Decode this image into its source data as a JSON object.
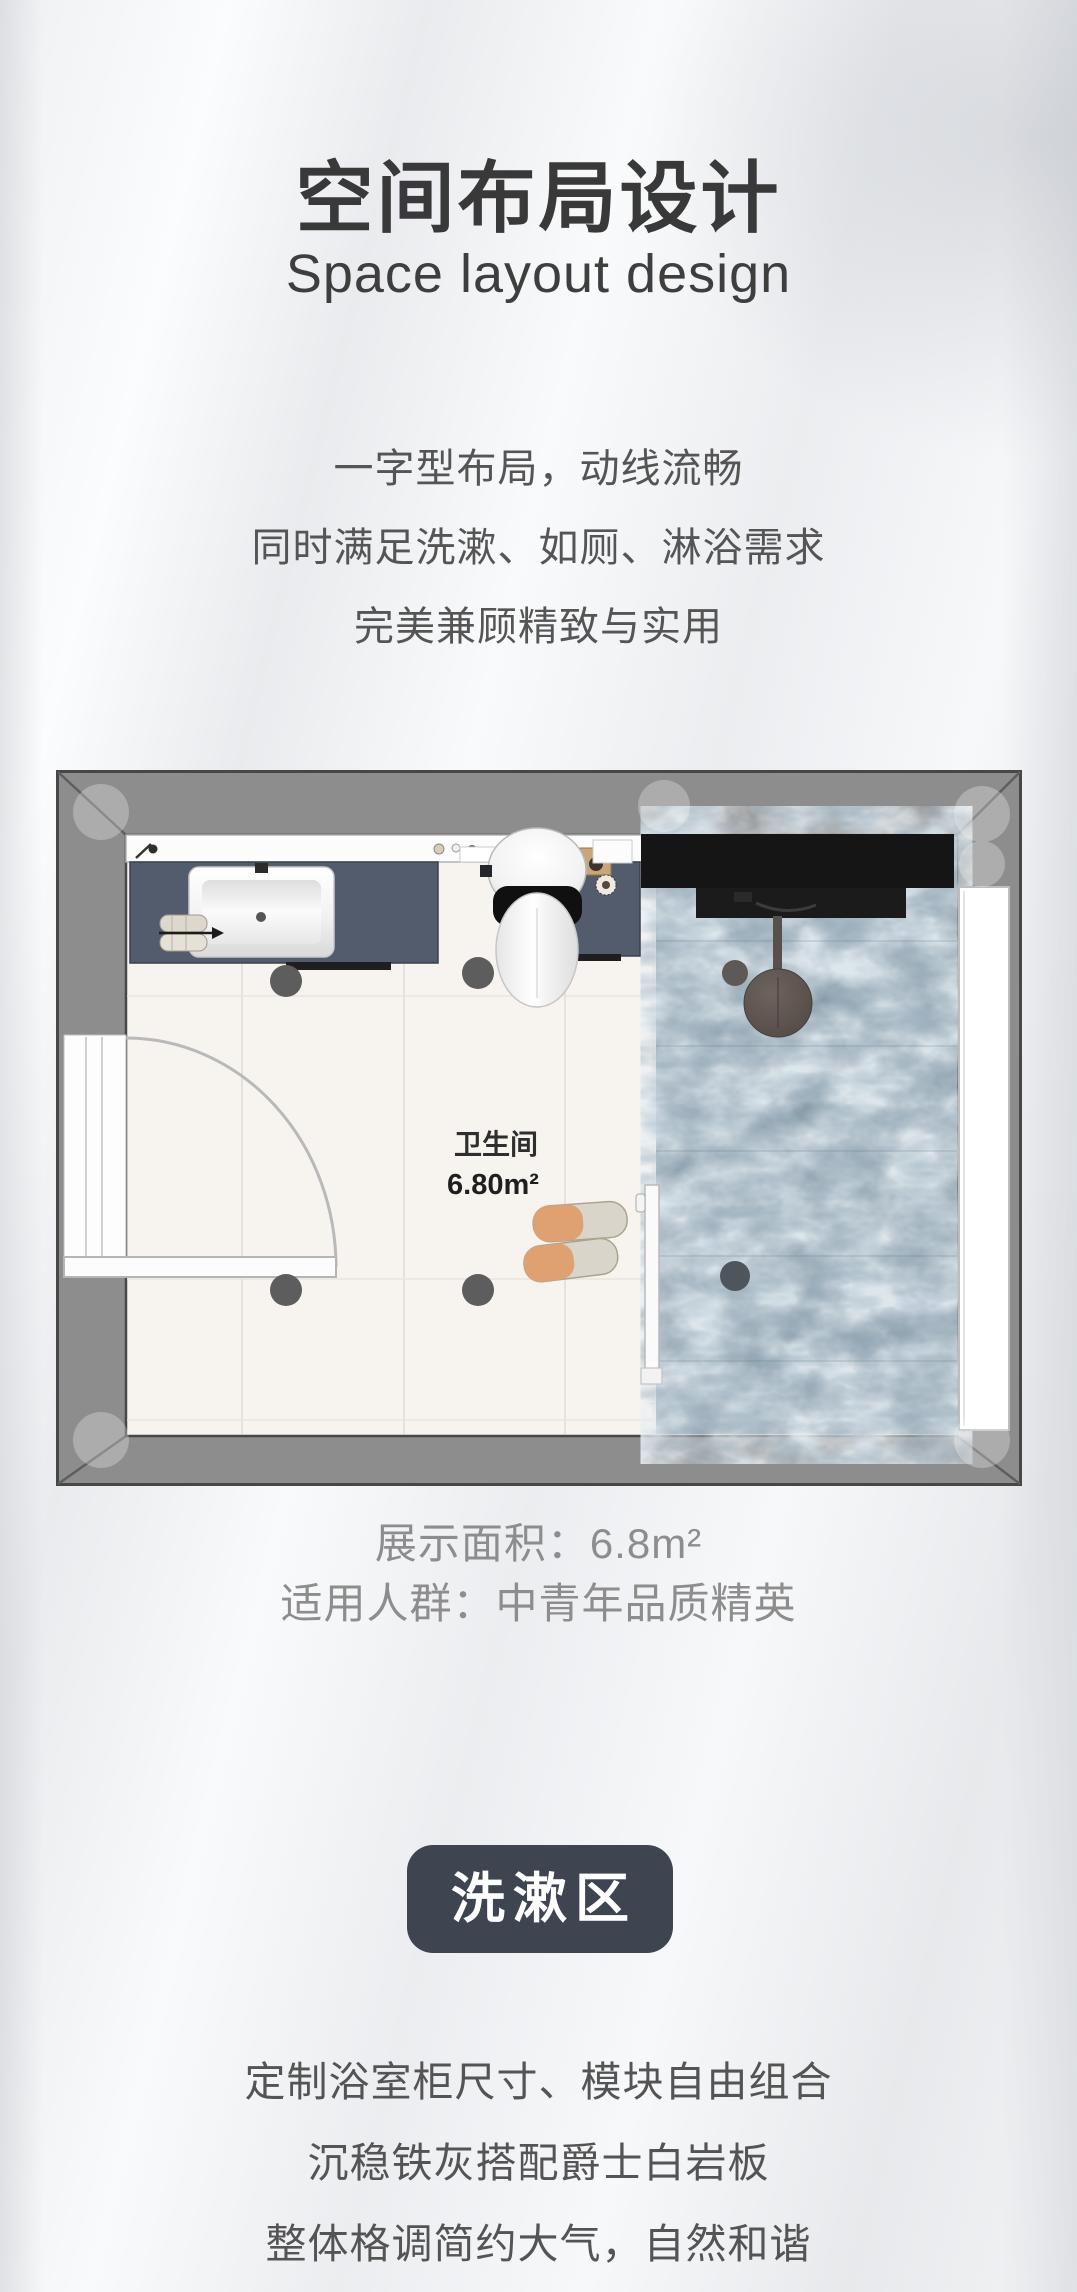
{
  "header": {
    "title": "空间布局设计",
    "subtitle": "Space layout design"
  },
  "intro_lines": [
    "一字型布局，动线流畅",
    "同时满足洗漱、如厕、淋浴需求",
    "完美兼顾精致与实用"
  ],
  "floorplan": {
    "room_label": "卫生间",
    "room_area": "6.80m²"
  },
  "specs": {
    "area_line": "展示面积：6.8m²",
    "audience_line": "适用人群：中青年品质精英"
  },
  "section_badge": "洗漱区",
  "feature_lines": [
    "定制浴室柜尺寸、模块自由组合",
    "沉稳铁灰搭配爵士白岩板",
    "整体格调简约大气，自然和谐"
  ],
  "colors": {
    "badge_bg": "#3e4551",
    "wall_gray": "#8d8d8d",
    "floor_cream": "#f7f3ef",
    "marble_blue": "#8095a3",
    "vanity_slate": "#525c6c",
    "shelf_black": "#151515"
  }
}
